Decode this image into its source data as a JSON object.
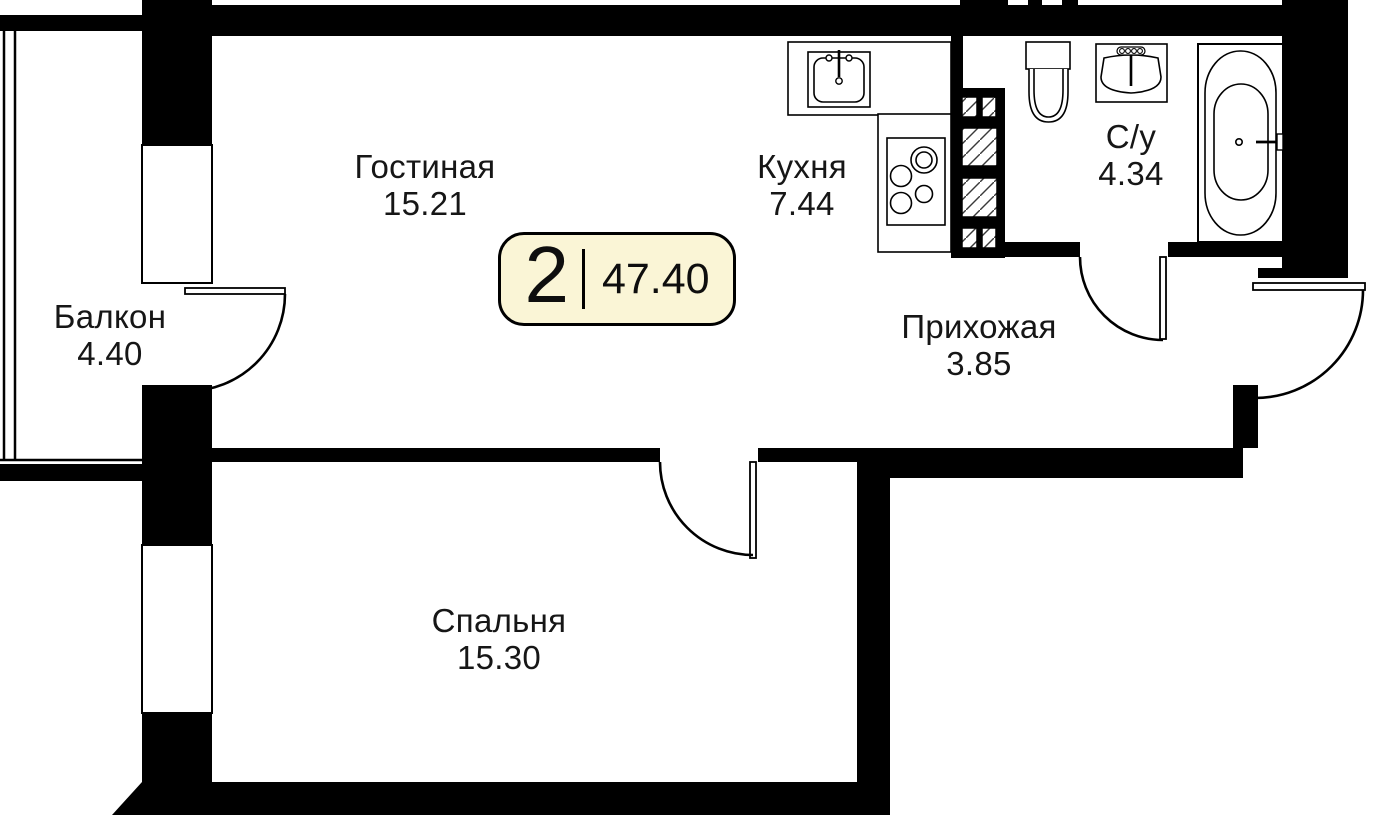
{
  "summary": {
    "rooms_count": "2",
    "total_area": "47.40"
  },
  "rooms": {
    "living": {
      "name": "Гостиная",
      "area": "15.21"
    },
    "kitchen": {
      "name": "Кухня",
      "area": "7.44"
    },
    "bathroom": {
      "name": "С/у",
      "area": "4.34"
    },
    "hallway": {
      "name": "Прихожая",
      "area": "3.85"
    },
    "balcony": {
      "name": "Балкон",
      "area": "4.40"
    },
    "bedroom": {
      "name": "Спальня",
      "area": "15.30"
    }
  },
  "fixtures": [
    "kitchen-sink",
    "cooktop",
    "ventilation-shaft",
    "toilet",
    "washbasin",
    "bathtub"
  ],
  "colors": {
    "wall": "#000000",
    "background": "#FFFFFF",
    "badge_background": "#FAF5D6",
    "badge_border": "#000000",
    "text": "#161616"
  }
}
